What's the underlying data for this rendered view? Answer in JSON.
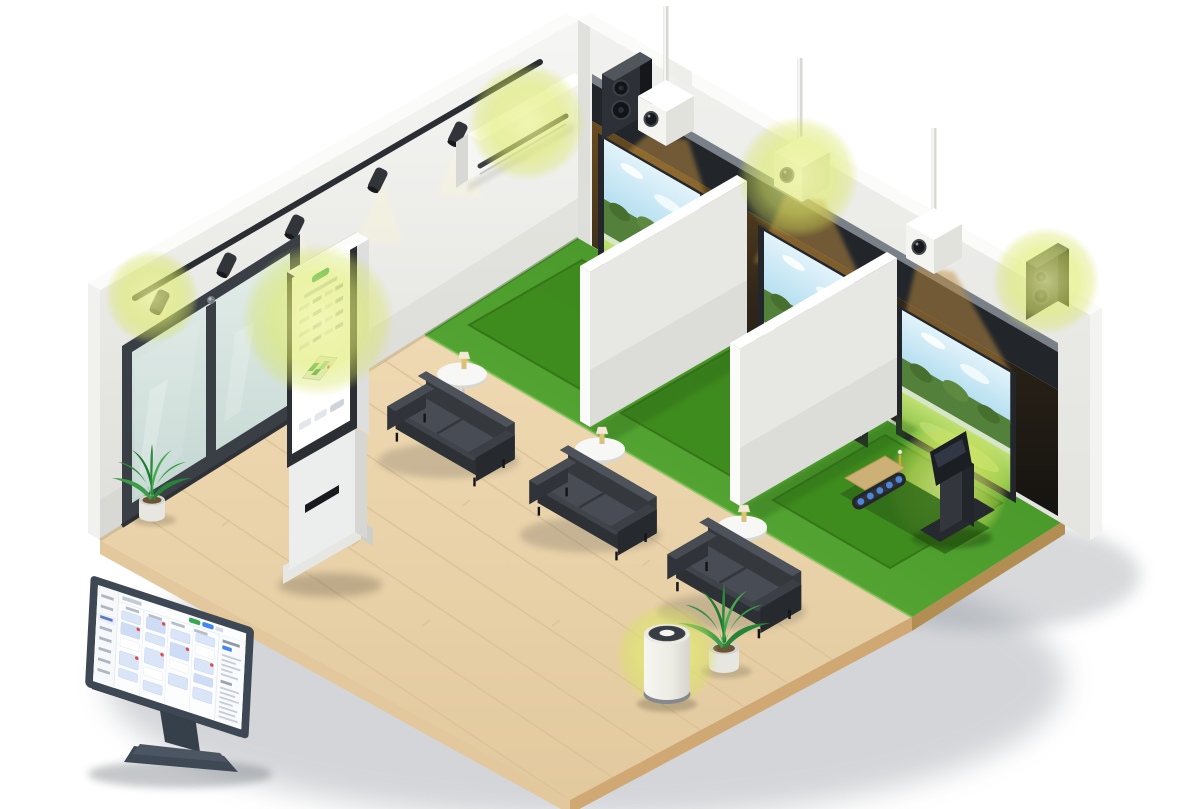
{
  "scene": {
    "description": "Isometric cutaway illustration of a screen-golf lounge with connected smart devices highlighted by green glow spots",
    "background_color": "#ffffff",
    "highlight_color": "#dcea66",
    "highlight_count": 7,
    "palette": {
      "turf_green": "#4c9e2a",
      "turf_mat_green": "#3e8a1e",
      "wood_floor": "#ead6b0",
      "wall_white": "#f0f0ee",
      "beam_charcoal": "#22262b",
      "device_white": "#f4f4f1",
      "sofa_charcoal": "#36393f",
      "screen_sky_blue": "#cdeaf6",
      "screen_fairway_green": "#9ccb52",
      "door_glass": "#d8e4e0",
      "dashboard_card_blue": "#dbe5f8",
      "dashboard_alert_red": "#e5484d",
      "dashboard_green_button": "#34a853",
      "dashboard_blue_button": "#4285f4",
      "kiosk_accent_green": "#2fa45c"
    },
    "devices": [
      {
        "id": "track-light",
        "label": "Track spotlight",
        "highlighted": true
      },
      {
        "id": "signage-kiosk",
        "label": "Digital signage kiosk",
        "highlighted": true
      },
      {
        "id": "air-conditioner",
        "label": "Wall air conditioner",
        "highlighted": true
      },
      {
        "id": "projector-1",
        "label": "Ceiling projector bay 1",
        "highlighted": false
      },
      {
        "id": "projector-2",
        "label": "Ceiling projector bay 2",
        "highlighted": true
      },
      {
        "id": "projector-3",
        "label": "Ceiling projector bay 3",
        "highlighted": false
      },
      {
        "id": "wall-speaker-corner",
        "label": "Wall speaker corner",
        "highlighted": false
      },
      {
        "id": "wall-speaker-right",
        "label": "Wall speaker right",
        "highlighted": true
      },
      {
        "id": "simulator-console",
        "label": "Golf simulator console",
        "highlighted": true
      },
      {
        "id": "air-purifier",
        "label": "Air purifier",
        "highlighted": true
      },
      {
        "id": "management-monitor",
        "label": "Management dashboard monitor",
        "highlighted": false
      }
    ],
    "furniture": {
      "sofas": 3,
      "side_tables": 3,
      "plants": 2,
      "simulator_bays": 3,
      "projection_screens": 3,
      "partition_walls": 2
    },
    "monitor_screen": {
      "type": "reservation-calendar-dashboard",
      "regions": [
        "left-sidebar",
        "top-toolbar",
        "booking-grid",
        "right-detail-panel"
      ]
    },
    "kiosk_screen": {
      "type": "booking-touch-ui",
      "regions": [
        "green-logo",
        "time-slot-table",
        "isometric-floor-map",
        "bottom-buttons"
      ]
    }
  }
}
